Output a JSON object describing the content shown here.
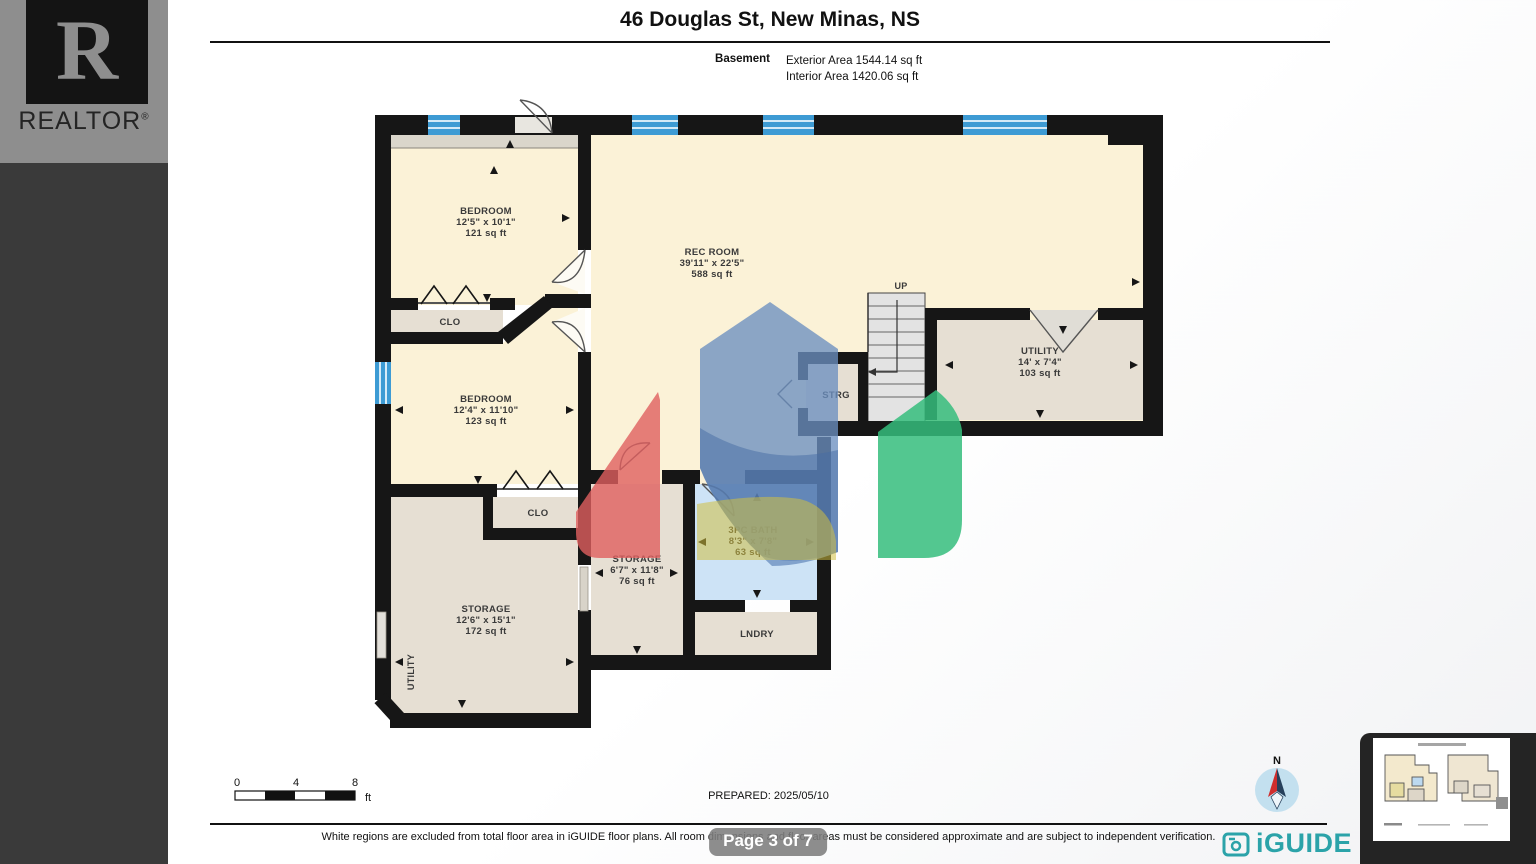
{
  "header": {
    "title": "46 Douglas St, New Minas, NS",
    "floor_label": "Basement",
    "exterior_area": "Exterior Area 1544.14 sq ft",
    "interior_area": "Interior Area 1420.06 sq ft"
  },
  "rooms": {
    "bedroom1": {
      "name": "BEDROOM",
      "dims": "12'5\" x 10'1\"",
      "area": "121 sq ft"
    },
    "rec_room": {
      "name": "REC ROOM",
      "dims": "39'11\" x 22'5\"",
      "area": "588 sq ft"
    },
    "bedroom2": {
      "name": "BEDROOM",
      "dims": "12'4\" x 11'10\"",
      "area": "123 sq ft"
    },
    "storage_large": {
      "name": "STORAGE",
      "dims": "12'6\" x 15'1\"",
      "area": "172 sq ft"
    },
    "storage_small": {
      "name": "STORAGE",
      "dims": "6'7\" x 11'8\"",
      "area": "76 sq ft"
    },
    "bath": {
      "name": "3PC BATH",
      "dims": "8'3\" x 7'8\"",
      "area": "63 sq ft"
    },
    "utility": {
      "name": "UTILITY",
      "dims": "14' x 7'4\"",
      "area": "103 sq ft"
    },
    "closet1": {
      "name": "CLO"
    },
    "closet2": {
      "name": "CLO"
    },
    "laundry": {
      "name": "LNDRY"
    },
    "strg": {
      "name": "STRG"
    },
    "stairs_up": {
      "name": "UP"
    },
    "utility_side": {
      "name": "UTILITY"
    }
  },
  "scale_bar": {
    "tick0": "0",
    "tick1": "4",
    "tick2": "8",
    "unit": "ft"
  },
  "footer": {
    "prepared": "PREPARED: 2025/05/10",
    "disclaimer": "White regions are excluded from total floor area in iGUIDE floor plans. All room dimensions and floor areas must be considered approximate and are subject to independent verification."
  },
  "page_badge": "Page 3 of 7",
  "branding": {
    "realtor_letter": "R",
    "realtor_text": "REALTOR",
    "registered": "®",
    "iguide_text": "iGUIDE",
    "compass_north": "N"
  },
  "colors": {
    "room_cream": "#fbf2d7",
    "room_gray": "#e6dfd3",
    "bath_blue": "#cde3f6",
    "window_blue": "#3d9bd4",
    "wall": "#161616",
    "iguide_teal": "#2ba3a9",
    "watermark_blue": "#6b8fc0",
    "watermark_red": "#e05f5f",
    "watermark_green": "#35bd7c",
    "watermark_yellow": "#d2bf40"
  }
}
